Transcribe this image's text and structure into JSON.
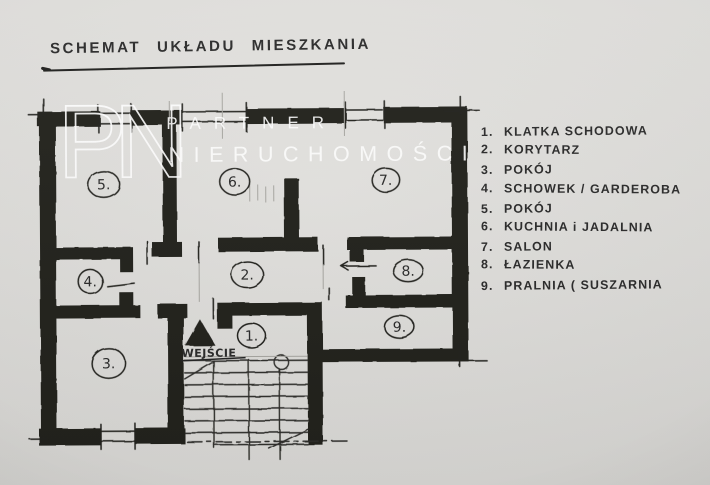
{
  "title": "SCHEMAT UKŁADU MIESZKANIA",
  "watermark": {
    "monogram": "PN",
    "line1": "PARTNER",
    "line2": "NIERUCHOMOŚCI"
  },
  "entrance_label": "WEJŚCIE",
  "rooms": [
    {
      "label": "1."
    },
    {
      "label": "2."
    },
    {
      "label": "3."
    },
    {
      "label": "4."
    },
    {
      "label": "5."
    },
    {
      "label": "6."
    },
    {
      "label": "7."
    },
    {
      "label": "8."
    },
    {
      "label": "9."
    }
  ],
  "legend": {
    "items": [
      {
        "num": "1.",
        "text": "KLATKA SCHODOWA"
      },
      {
        "num": "2.",
        "text": "KORYTARZ"
      },
      {
        "num": "3.",
        "text": "POKÓJ"
      },
      {
        "num": "4.",
        "text": "SCHOWEK / GARDEROBA"
      },
      {
        "num": "5.",
        "text": "POKÓJ"
      },
      {
        "num": "6.",
        "text": "KUCHNIA i JADALNIA"
      },
      {
        "num": "7.",
        "text": "SALON"
      },
      {
        "num": "8.",
        "text": "ŁAZIENKA"
      },
      {
        "num": "9.",
        "text": "PRALNIA ( SUSZARNIA"
      }
    ]
  },
  "colors": {
    "ink": "#20201e",
    "pencil": "#a8a7a2",
    "text": "#2b2b2b",
    "watermark": "#ffffff",
    "paper_light": "#e4e3e0",
    "paper_dark": "#cfceca"
  }
}
